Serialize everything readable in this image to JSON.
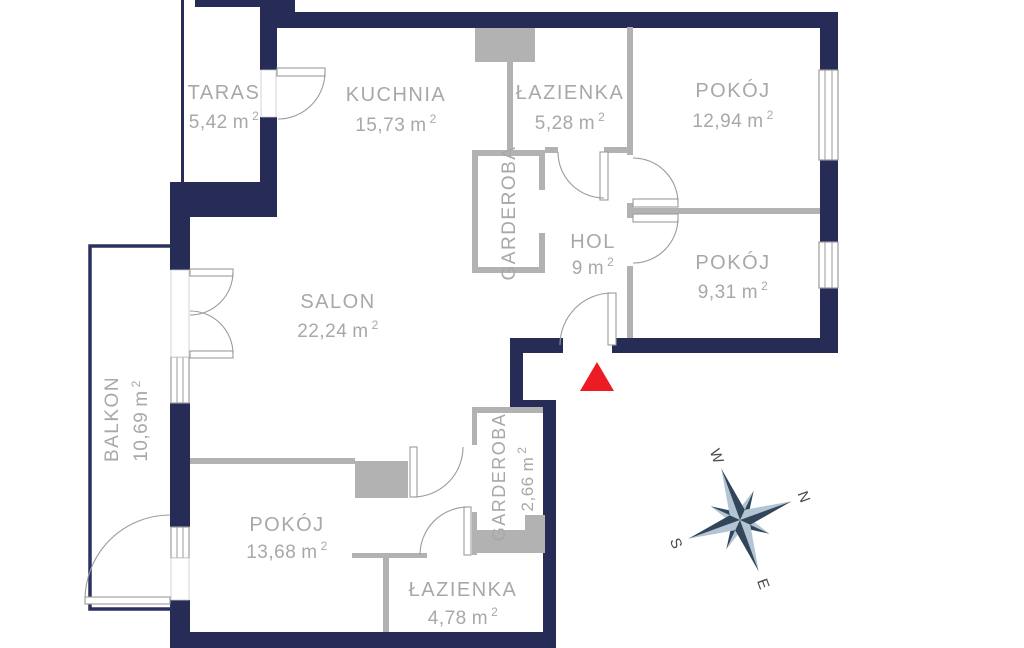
{
  "labels": {
    "unit": "m",
    "sup": "2"
  },
  "rooms": {
    "taras": {
      "name": "TARAS",
      "area": "5,42"
    },
    "kuchnia": {
      "name": "KUCHNIA",
      "area": "15,73"
    },
    "lazienka_gorna": {
      "name": "ŁAZIENKA",
      "area": "5,28"
    },
    "pokoj_gorny": {
      "name": "POKÓJ",
      "area": "12,94"
    },
    "garderoba_hol": {
      "name": "GARDEROBA"
    },
    "hol": {
      "name": "HOL",
      "area": "9"
    },
    "pokoj_srodkowy": {
      "name": "POKÓJ",
      "area": "9,31"
    },
    "salon": {
      "name": "SALON",
      "area": "22,24"
    },
    "balkon": {
      "name": "BALKON",
      "area": "10,69"
    },
    "garderoba_dolna": {
      "name": "GARDEROBA",
      "area": "2,66"
    },
    "pokoj_dolny": {
      "name": "POKÓJ",
      "area": "13,68"
    },
    "lazienka_dolna": {
      "name": "ŁAZIENKA",
      "area": "4,78"
    }
  },
  "compass": {
    "w": "W",
    "n": "N",
    "s": "S",
    "e": "E"
  },
  "colors": {
    "wall": "#262c55",
    "outline": "#2a3160",
    "interior_wall": "#b2b2b2",
    "door": "#9b9b9b",
    "label": "#a8a8a8",
    "entrance_marker": "#ed1c24",
    "compass_light": "#b3c4d2",
    "compass_dark": "#31455b",
    "compass_text": "#4a4a4a"
  }
}
